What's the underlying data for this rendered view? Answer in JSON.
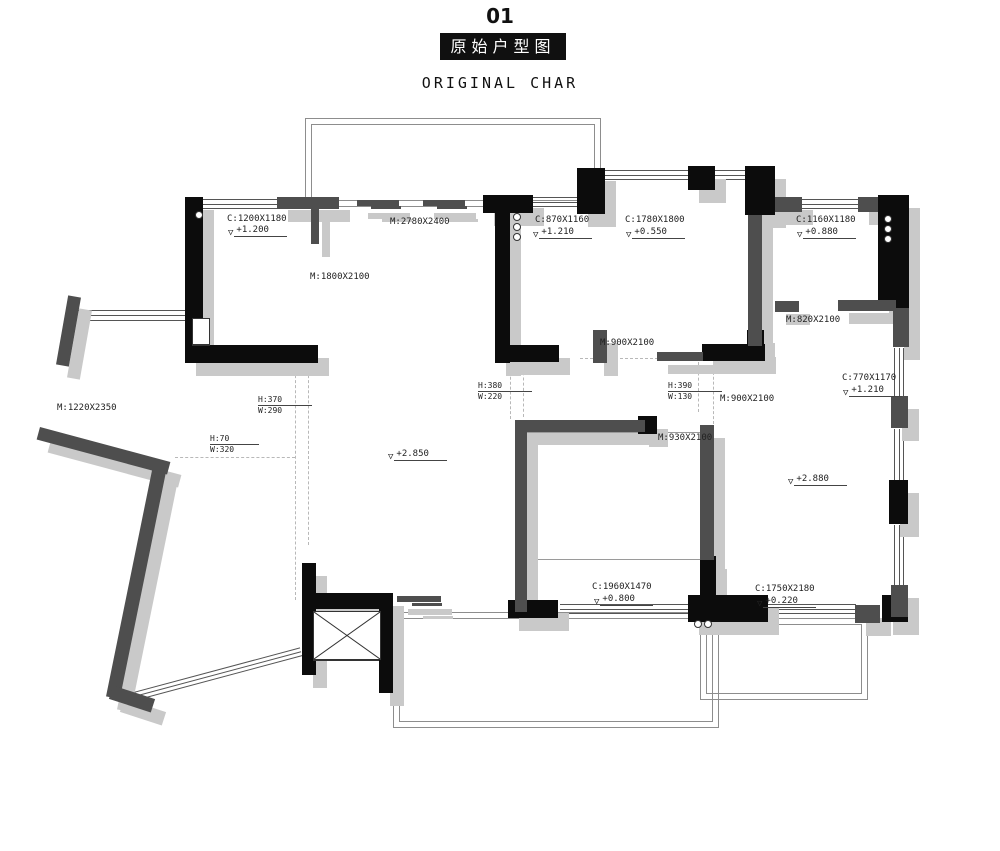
{
  "title": {
    "index": "01",
    "name_zh": "原始户型图",
    "name_en": "ORIGINAL CHAR"
  },
  "icons": {
    "level_triangle": "▽"
  },
  "colors": {
    "wall_black": "#0c0c0c",
    "wall_gray": "#4e4e4e",
    "shadow": "#c9c9c9",
    "title_box": "#101010"
  },
  "labels": {
    "win_tl": "C:1200X1180",
    "lvl_tl": "+1.200",
    "door_tl": "M:1800X2100",
    "door_balcony": "M:2780X2400",
    "win_bath": "C:870X1160",
    "lvl_bath": "+1.210",
    "win_bed2": "C:1780X1800",
    "lvl_bed2": "+0.550",
    "win_tr": "C:1160X1180",
    "lvl_tr": "+0.880",
    "door_820": "M:820X2100",
    "door_900a": "M:900X2100",
    "door_900b": "M:900X2100",
    "door_930": "M:930X2100",
    "door_1220": "M:1220X2350",
    "win_770": "C:770X1170",
    "lvl_770": "+1.210",
    "lvl_living": "+2.850",
    "lvl_bedroom": "+2.880",
    "win_1960": "C:1960X1470",
    "lvl_1960": "+0.800",
    "win_1750": "C:1750X2180",
    "lvl_1750": "+0.220",
    "f1_h": "H:380",
    "f1_w": "W:220",
    "f2_h": "H:390",
    "f2_w": "W:130",
    "f3_h": "H:370",
    "f3_w": "W:290",
    "f4_h": "H:70",
    "f4_w": "W:320"
  }
}
